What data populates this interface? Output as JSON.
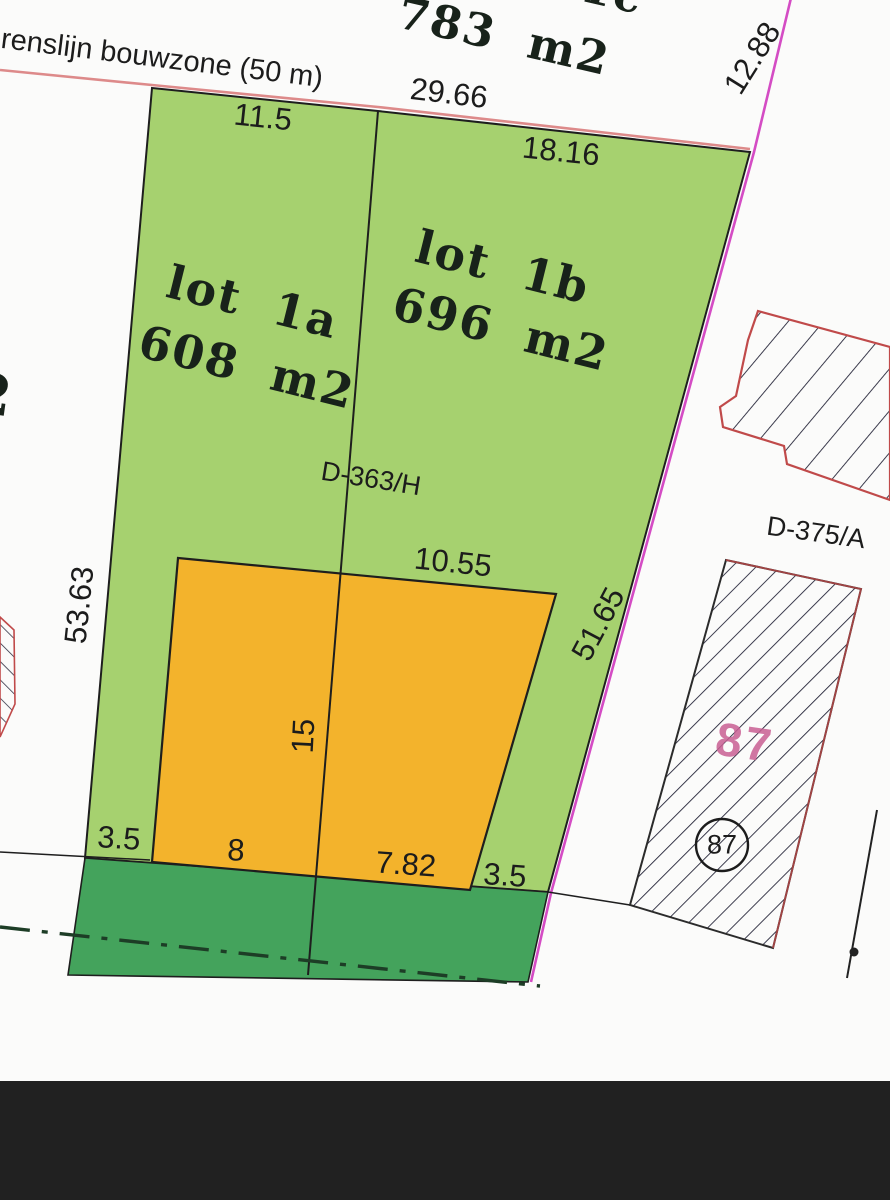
{
  "colors": {
    "bg": "#fbfbfa",
    "lot-green": "#a6d16f",
    "strip-green": "#44a35c",
    "zone-orange": "#f3b32c",
    "boundary-black": "#1e1e1e",
    "magenta": "#d44cc4",
    "grensline-red": "#dd8a8a",
    "building-red": "#c04a4a",
    "hatch-dark": "#26263a",
    "pink-87": "#c95f93",
    "centerline-green": "#1d3d26",
    "footer-black": "#212121"
  },
  "labels": {
    "boundary_line": "renslijn bouwzone (50 m)",
    "lot_1c_name": "lot 1c",
    "lot_1c_area": "783 m2",
    "lot_1a_name": "lot 1a",
    "lot_1a_area": "608 m2",
    "lot_1b_name": "lot 1b",
    "lot_1b_area": "696 m2",
    "parcel_d363": "D-363/H",
    "parcel_d375": "D-375/A",
    "parcel_87": "87",
    "parcel_87_circled": "87",
    "edge_fragment": "2"
  },
  "measurements": {
    "front_1a": "11.5",
    "front_total": "29.66",
    "front_1b": "18.16",
    "side_right_top": "12.88",
    "side_left": "53.63",
    "side_right": "51.65",
    "zone_rear": "10.55",
    "zone_depth": "15",
    "setback_left": "3.5",
    "zone_front_left": "8",
    "zone_front_right": "7.82",
    "setback_right": "3.5"
  }
}
